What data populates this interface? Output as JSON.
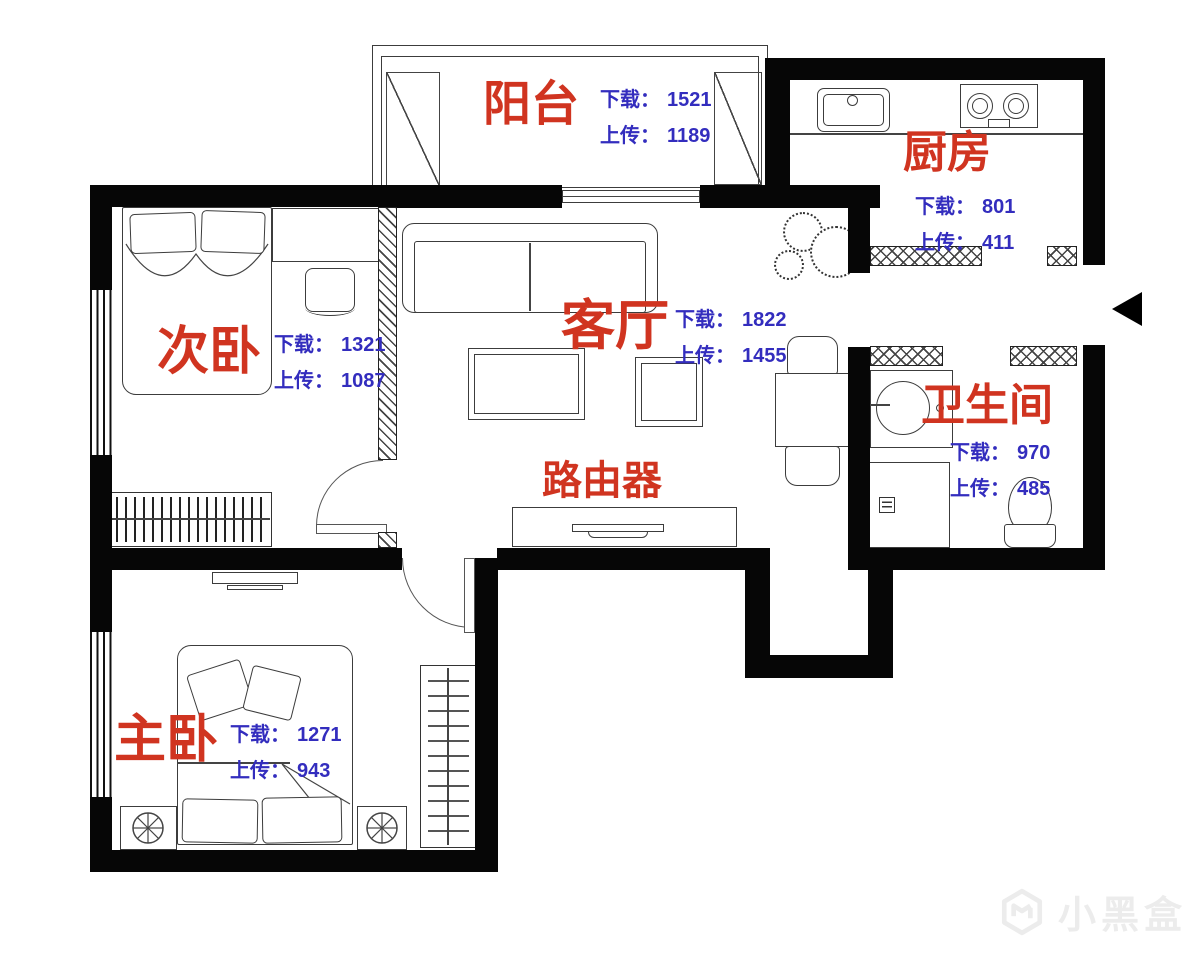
{
  "labels": {
    "download": "下载：",
    "upload": "上传："
  },
  "rooms": {
    "balcony": {
      "name": "阳台",
      "download": "1521",
      "upload": "1189"
    },
    "kitchen": {
      "name": "厨房",
      "download": "801",
      "upload": "411"
    },
    "second_bedroom": {
      "name": "次卧",
      "download": "1321",
      "upload": "1087"
    },
    "living_room": {
      "name": "客厅",
      "download": "1822",
      "upload": "1455"
    },
    "bathroom": {
      "name": "卫生间",
      "download": "970",
      "upload": "485"
    },
    "master_bedroom": {
      "name": "主卧",
      "download": "1271",
      "upload": "943"
    }
  },
  "router_label": "路由器",
  "watermark_text": "小黑盒",
  "colors": {
    "room_label": "#d03420",
    "stats": "#332dbe",
    "wall": "#060606",
    "watermark": "#ececec"
  }
}
